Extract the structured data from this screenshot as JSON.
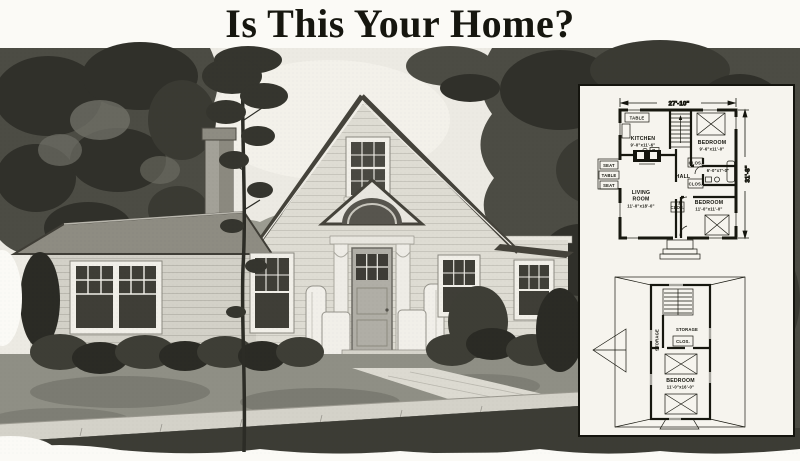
{
  "title": "Is This Your Home?",
  "colors": {
    "ink": "#14140d",
    "paper": "#fbfaf6",
    "plan_paper": "#f6f4ee",
    "foliage_dark": "#30302a",
    "foliage_mid": "#4c4c44"
  },
  "plans": {
    "first_floor": {
      "width_dim": "27'-10\"",
      "depth_dim": "31'-8\"",
      "alcove_table": "TABLE",
      "kitchen_name": "KITCHEN",
      "kitchen_dim": "9'-0\"x11'-6\"",
      "range_label": "R.",
      "bedroom1_name": "BEDROOM",
      "bedroom1_dim": "9'-6\"x11'-0\"",
      "nook_seat_top": "SEAT",
      "nook_table": "TABLE",
      "nook_seat_bottom": "SEAT",
      "hall_name": "HALL",
      "bath_dim": "6'-0\"x7'-0\"",
      "closet_label": "CLOS.",
      "living_room_line1": "LIVING",
      "living_room_line2": "ROOM",
      "living_room_dim": "11'-0\"x18'-0\"",
      "bedroom2_name": "BEDROOM",
      "bedroom2_dim": "11'-0\"x11'-0\""
    },
    "second_floor": {
      "storage_left": "STORAGE",
      "storage_center": "STORAGE",
      "closet_label": "CLOS.",
      "bedroom_name": "BEDROOM",
      "bedroom_dim": "11'-0\"x16'-0\""
    }
  }
}
